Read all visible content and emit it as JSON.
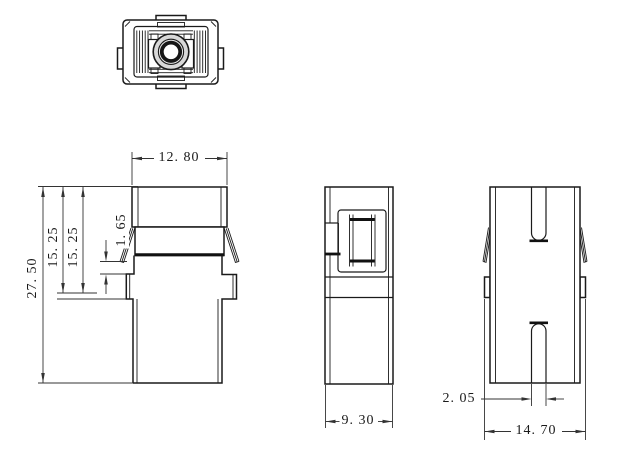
{
  "drawing": {
    "background_color": "#ffffff",
    "line_color": "#1a1a1a",
    "fill_gray": "#d8d8d8",
    "fill_light_gray": "#e9e9e9",
    "fill_latch_gray": "#c9c9c9",
    "dimensions": {
      "front_width": "12. 80",
      "overall_height": "27. 50",
      "upper_height_a": "15. 25",
      "upper_height_b": "15. 25",
      "latch_gap": "1. 65",
      "side_depth": "9. 30",
      "slot_width": "2. 05",
      "flange_width": "14. 70"
    }
  }
}
